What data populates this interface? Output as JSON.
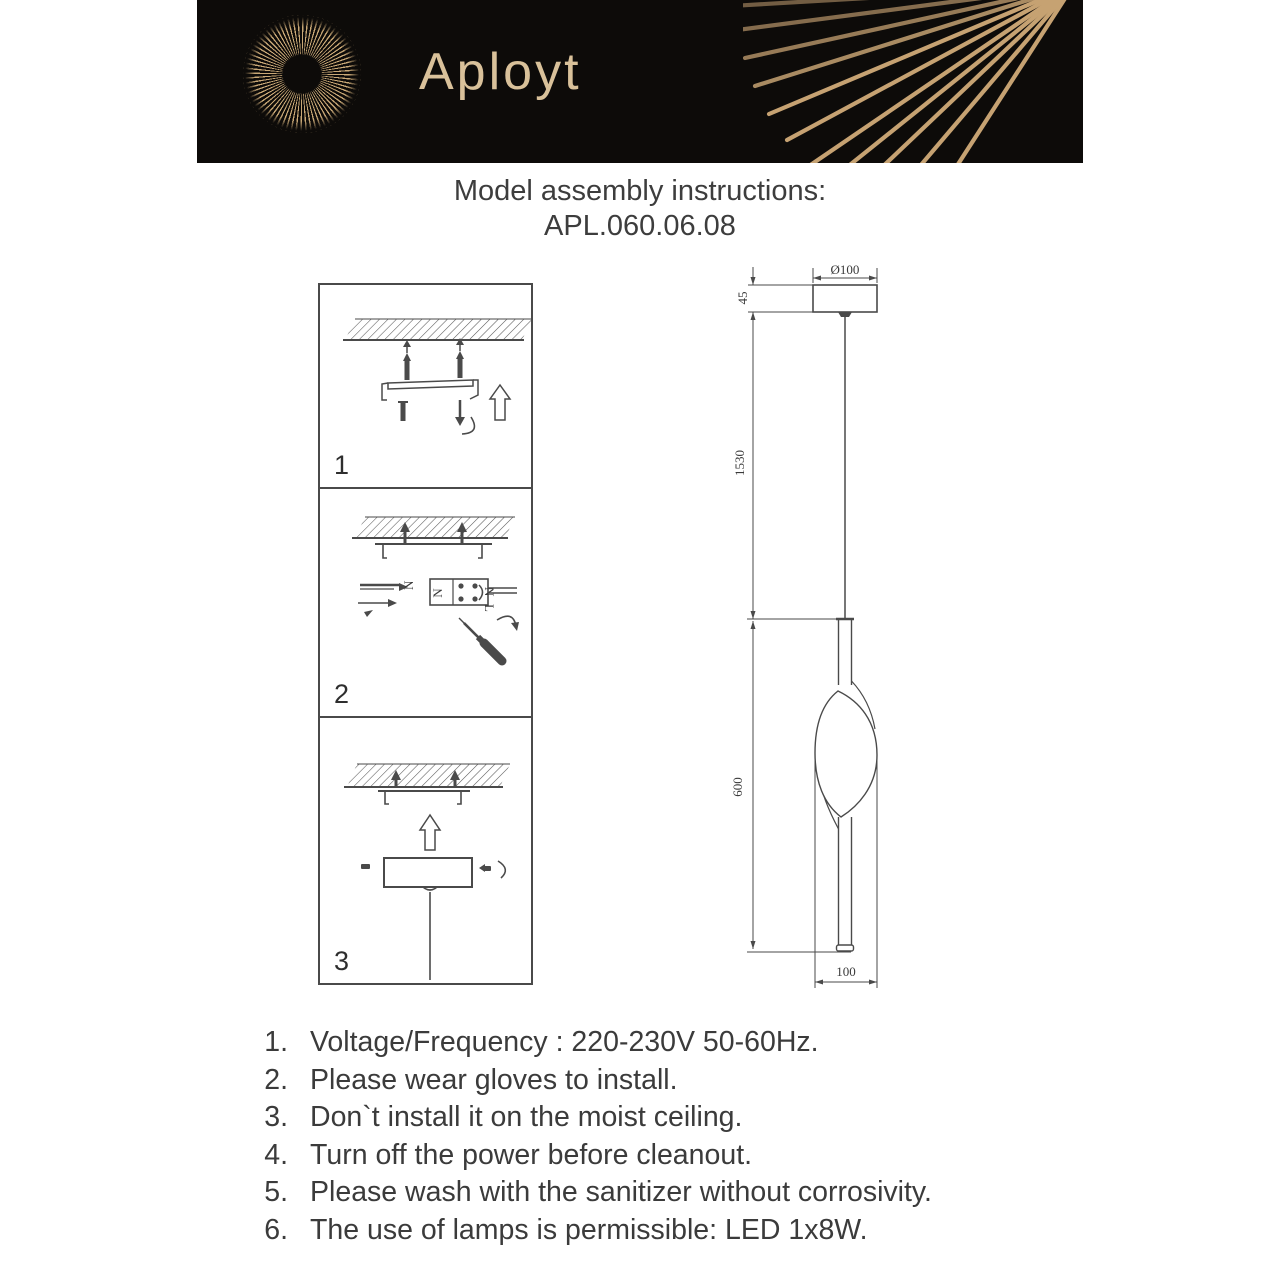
{
  "header": {
    "brand": "Aployt",
    "bg_color": "#0d0b09",
    "gold_color": "#c9a876",
    "brand_color": "#d9c19a"
  },
  "title": {
    "line1": "Model assembly instructions:",
    "line2": "APL.060.06.08"
  },
  "steps": [
    {
      "label": "1"
    },
    {
      "label": "2"
    },
    {
      "label": "3"
    }
  ],
  "diagram": {
    "canopy_diameter": "Ø100",
    "canopy_height": "45",
    "suspension_length": "1530",
    "body_length": "600",
    "body_width": "100",
    "terminal_n": "N",
    "terminal_l": "L",
    "wire_n": "N"
  },
  "instructions": {
    "items": [
      {
        "num": "1.",
        "text": "Voltage/Frequency : 220-230V 50-60Hz."
      },
      {
        "num": "2.",
        "text": "Please wear gloves to install."
      },
      {
        "num": "3.",
        "text": "Don`t install it on the moist ceiling."
      },
      {
        "num": "4.",
        "text": "Turn off the power before cleanout."
      },
      {
        "num": "5.",
        "text": "Please wash with the sanitizer without corrosivity."
      },
      {
        "num": "6.",
        "text": "The use of lamps is permissible: LED 1x8W."
      }
    ]
  }
}
